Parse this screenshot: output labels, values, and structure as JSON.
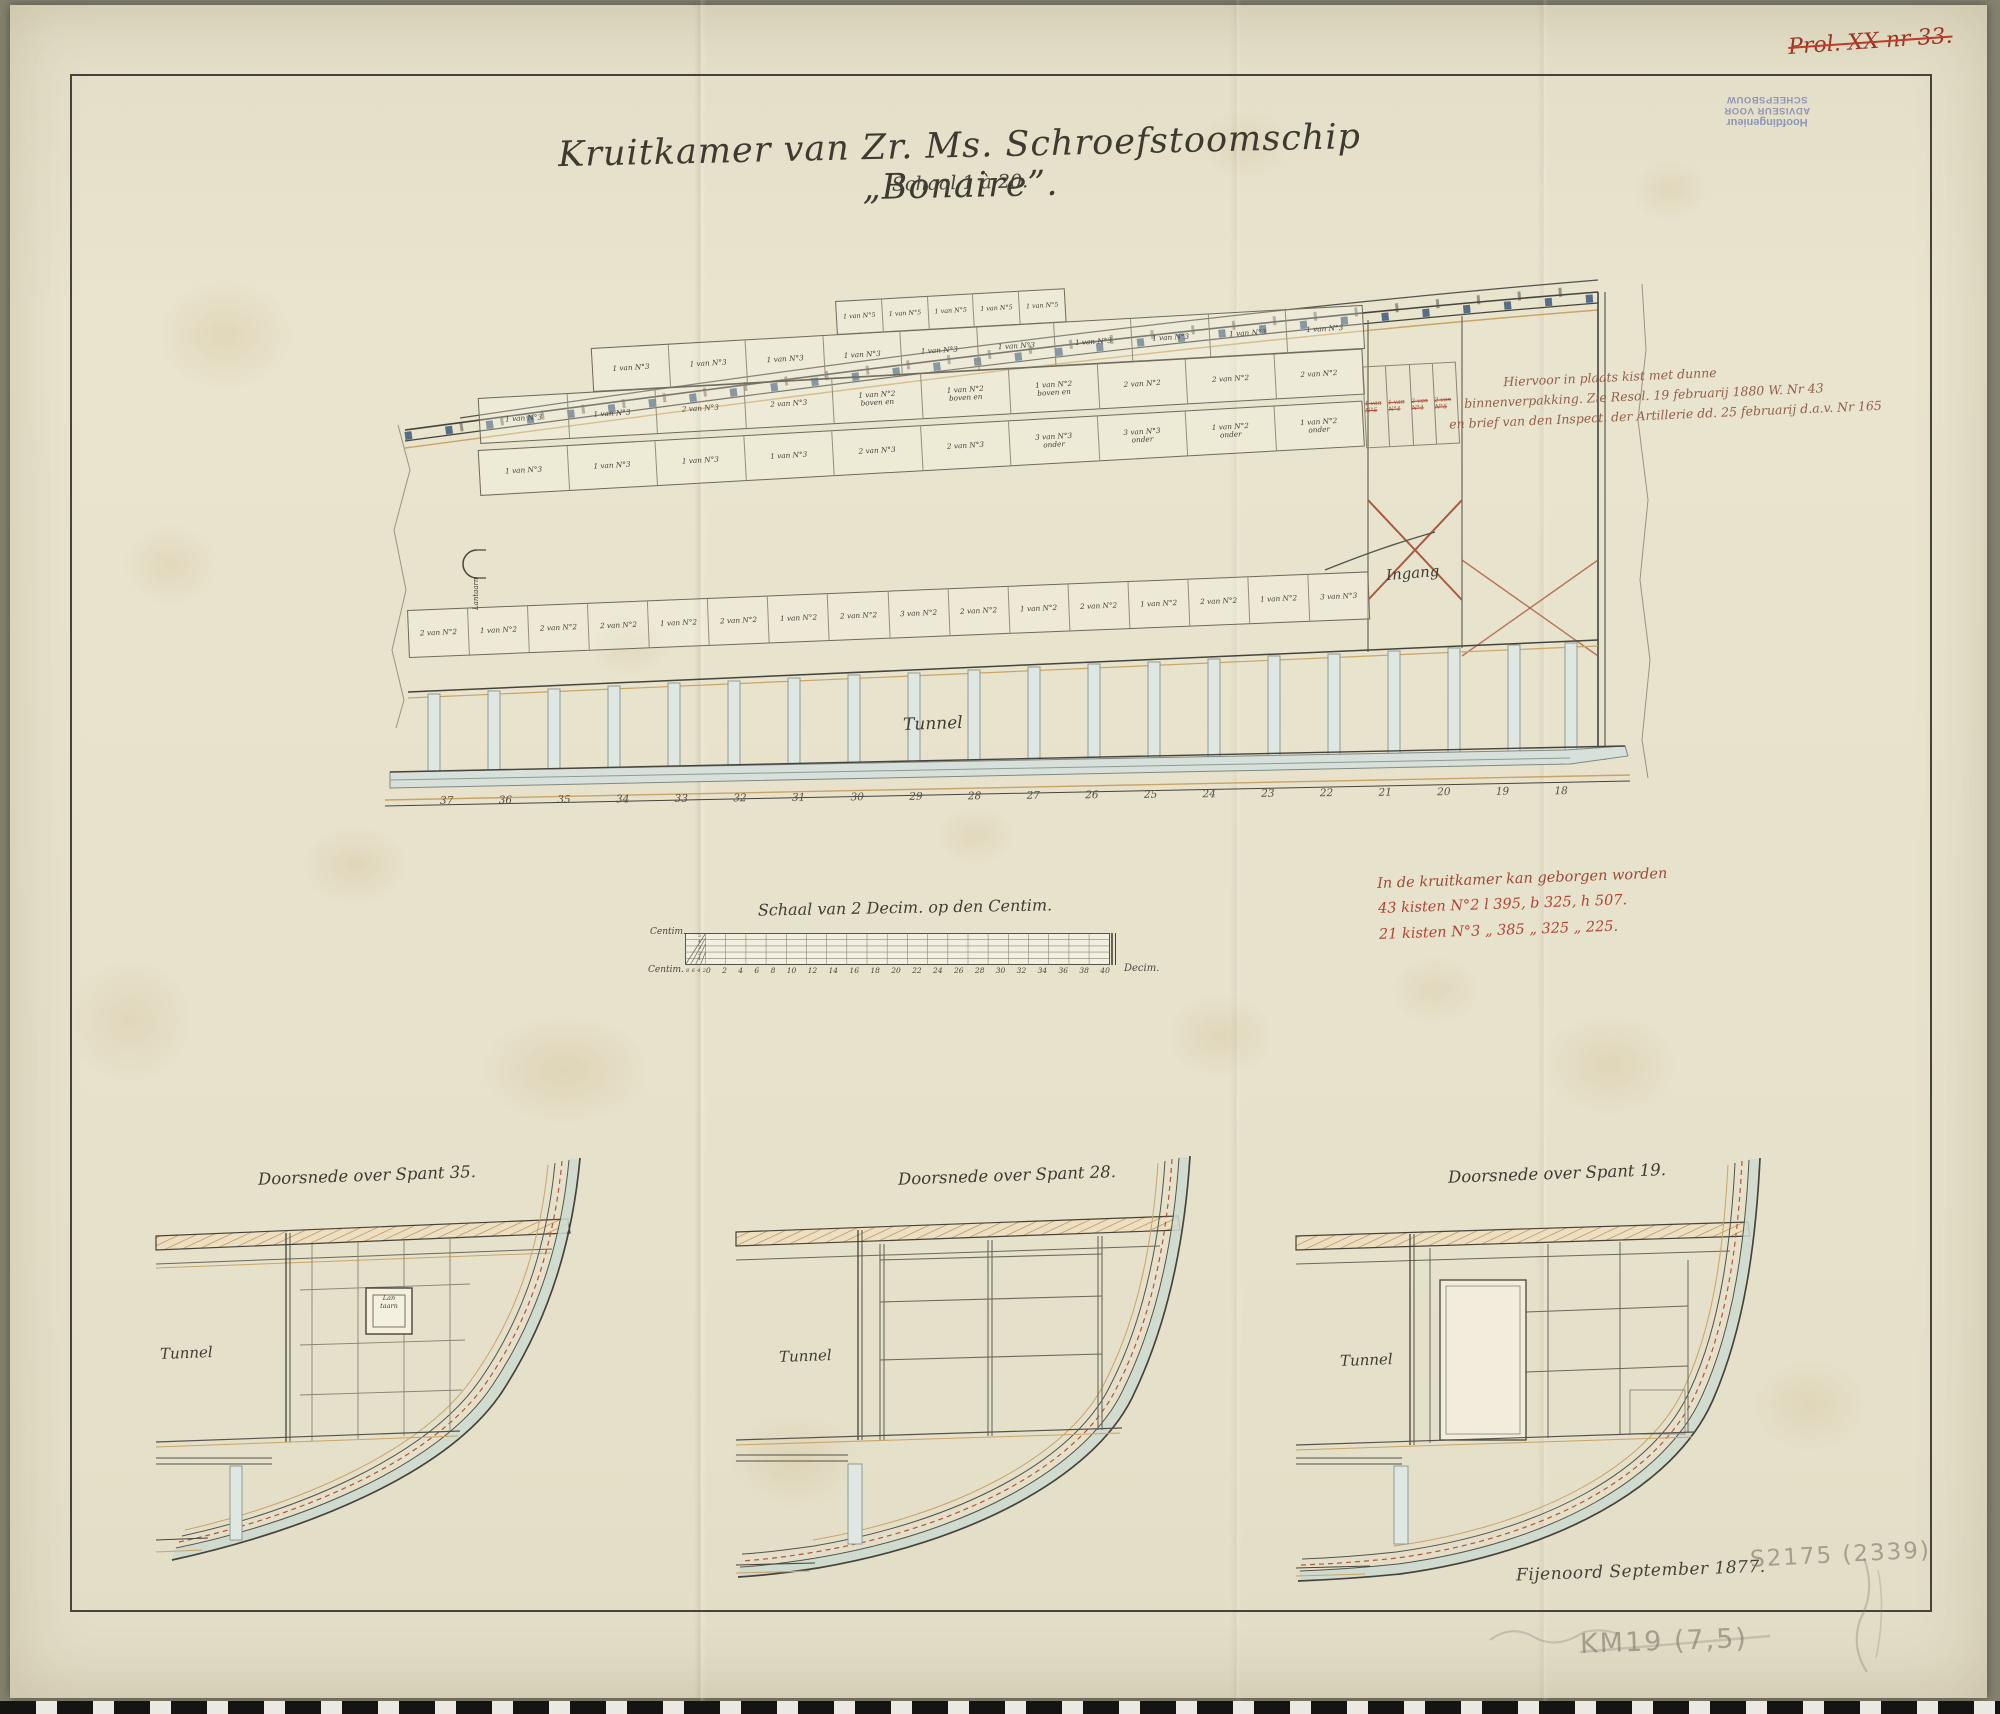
{
  "archive": {
    "corner_mark": "Prol. XX nr 33.",
    "stamp": {
      "line1": "Hoofdingenieur",
      "line2": "ADVISEUR VOOR SCHEEPSBOUW"
    },
    "pencil_inventory": "S2175 (2339)",
    "pencil_catalog": "KM19 (7,5)",
    "signature": "Fijenoord September 1877."
  },
  "title": {
    "main": "Kruitkamer van Zr. Ms. Schroefstoomschip „Bonaire”.",
    "scale_note": "Schaal 1 à 20."
  },
  "plan": {
    "labels": {
      "tunnel": "Tunnel",
      "ingang": "Ingang",
      "lantaarn": "Lantaarn"
    },
    "frame_numbers": [
      "37",
      "36",
      "35",
      "34",
      "33",
      "32",
      "31",
      "30",
      "29",
      "28",
      "27",
      "26",
      "25",
      "24",
      "23",
      "22",
      "21",
      "20",
      "19",
      "18"
    ],
    "racks": {
      "row_n5": [
        "1 van N°5",
        "1 van N°5",
        "1 van N°5",
        "1 van N°5",
        "1 van N°5"
      ],
      "row_a": [
        "1 van N°3",
        "1 van N°3",
        "1 van N°3",
        "1 van N°3",
        "1 van N°3",
        "1 van N°3",
        "1 van N°3",
        "1 van N°3",
        "1 van N°3",
        "1 van N°3"
      ],
      "row_b": [
        "1 van N°3",
        "1 van N°3",
        "2 van N°3",
        "2 van N°3",
        "1 van N°2\nboven en",
        "1 van N°2\nboven en",
        "1 van N°2\nboven en",
        "2 van N°2",
        "2 van N°2",
        "2 van N°2"
      ],
      "row_c": [
        "1 van N°3",
        "1 van N°3",
        "1 van N°3",
        "1 van N°3",
        "2 van N°3",
        "2 van N°3",
        "3 van N°3\nonder",
        "3 van N°3\nonder",
        "1 van N°2\nonder",
        "1 van N°2\nonder"
      ],
      "orlop": [
        "2 van N°2",
        "1 van N°2",
        "2 van N°2",
        "2 van N°2",
        "1 van N°2",
        "2 van N°2",
        "1 van N°2",
        "2 van N°2",
        "3 van N°2",
        "2 van N°2",
        "1 van N°2",
        "2 van N°2",
        "1 van N°2",
        "2 van N°2",
        "1 van N°2",
        "3 van N°3"
      ],
      "struck": [
        "1 van N°5",
        "1 van N°4",
        "2 van N°4",
        "2 van N°5"
      ]
    },
    "annotation": {
      "line1": "Hiervoor in plaats kist met dunne",
      "line2": "binnenverpakking. Zie Resol. 19 februarij 1880 W. Nr 43",
      "line3": "en brief van den Inspect. der Artillerie dd. 25 februarij d.a.v. Nr 165"
    }
  },
  "capacity_note": {
    "line1": "In de kruitkamer kan geborgen worden",
    "line2": "43 kisten N°2   l 395, b 325, h 507.",
    "line3": "21 kisten N°3   „ 385  „ 325  „ 225."
  },
  "scale_bar": {
    "title": "Schaal van 2 Decim. op den Centim.",
    "unit_left_top": "Centim.",
    "unit_left_bottom": "Centim.",
    "unit_right": "Decim.",
    "side_ticks": [
      "5",
      "4",
      "3",
      "2",
      "1"
    ],
    "pre_ticks": [
      "8",
      "6",
      "4",
      "2"
    ],
    "ticks": [
      "0",
      "2",
      "4",
      "6",
      "8",
      "10",
      "12",
      "14",
      "16",
      "18",
      "20",
      "22",
      "24",
      "26",
      "28",
      "30",
      "32",
      "34",
      "36",
      "38",
      "40"
    ]
  },
  "sections": [
    {
      "title": "Doorsnede over Spant 35.",
      "tunnel": "Tunnel",
      "box_label": "Lan\ntaarn"
    },
    {
      "title": "Doorsnede over Spant 28.",
      "tunnel": "Tunnel"
    },
    {
      "title": "Doorsnede over Spant 19.",
      "tunnel": "Tunnel"
    }
  ],
  "colors": {
    "paper": "#e8e3cd",
    "ink": "#46433a",
    "ochre": "#c9a467",
    "wash_blue": "#ccdad1",
    "red_ink": "#a85a40",
    "note_red": "#9c4a38",
    "stamp_purple": "#7b82b4",
    "pencil": "#7d766a"
  }
}
